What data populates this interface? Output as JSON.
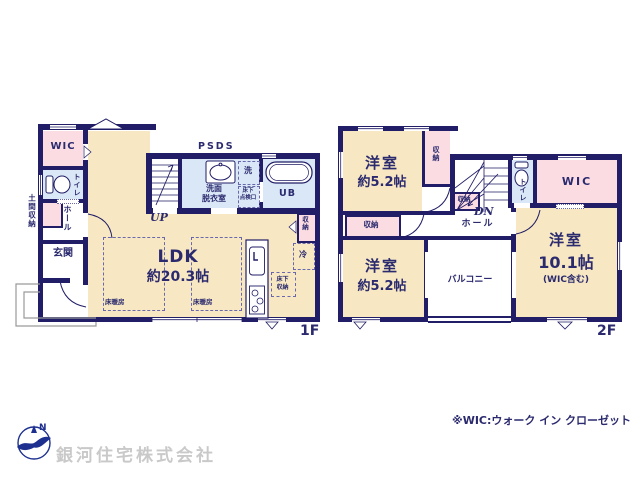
{
  "footer": {
    "note": "※WIC:ウォーク イン クローゼット",
    "company": "銀河住宅株式会社"
  },
  "floor1": {
    "label": "1F",
    "wic": "WIC",
    "toilet": "トイレ",
    "doma_storage": "土間収納",
    "hall": "ホール",
    "genkan": "玄関",
    "ldk_name": "LDK",
    "ldk_size": "約20.3帖",
    "floor_heating": "床暖房",
    "psds": "PSDS",
    "up": "UP",
    "washroom_line1": "洗面",
    "washroom_line2": "脱衣室",
    "laundry": "洗",
    "inspection_line1": "床下",
    "inspection_line2": "点検口",
    "ub": "UB",
    "storage": "収納",
    "fridge": "冷",
    "underfloor_line1": "床下",
    "underfloor_line2": "収納"
  },
  "floor2": {
    "label": "2F",
    "bedroom1_name": "洋室",
    "bedroom1_size": "約5.2帖",
    "bedroom2_name": "洋室",
    "bedroom2_size": "約5.2帖",
    "bedroom3_name": "洋室",
    "bedroom3_size": "10.1帖",
    "bedroom3_note": "(WIC含む)",
    "closet1": "収納",
    "closet2": "収納",
    "closet3": "収納",
    "wic": "WIC",
    "toilet": "トイレ",
    "hall": "ホール",
    "dn": "DN",
    "balcony": "バルコニー"
  },
  "colors": {
    "wall": "#211d66",
    "text": "#2b2a6e",
    "room_cream": "#f7e8c3",
    "room_pink": "#fadce2",
    "room_blue": "#d9e7f6",
    "company_gray": "#c9c9c9",
    "logo_blue": "#1d2f8f"
  }
}
